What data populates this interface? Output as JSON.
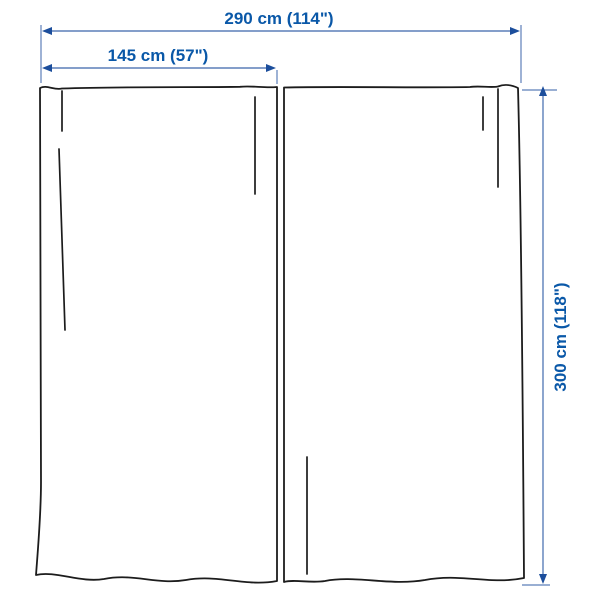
{
  "diagram": {
    "type": "product-dimension-diagram",
    "subject": "curtains, pair of 2 panels",
    "labels": {
      "total_width": "290 cm (114\")",
      "panel_width": "145 cm (57\")",
      "panel_height": "300 cm (118\")"
    },
    "colors": {
      "label_text": "#0a58a8",
      "dimension_line": "#5c7fb9",
      "arrowhead": "#1c4e9c",
      "panel_outline": "#1c1c1c",
      "background": "#ffffff"
    }
  }
}
